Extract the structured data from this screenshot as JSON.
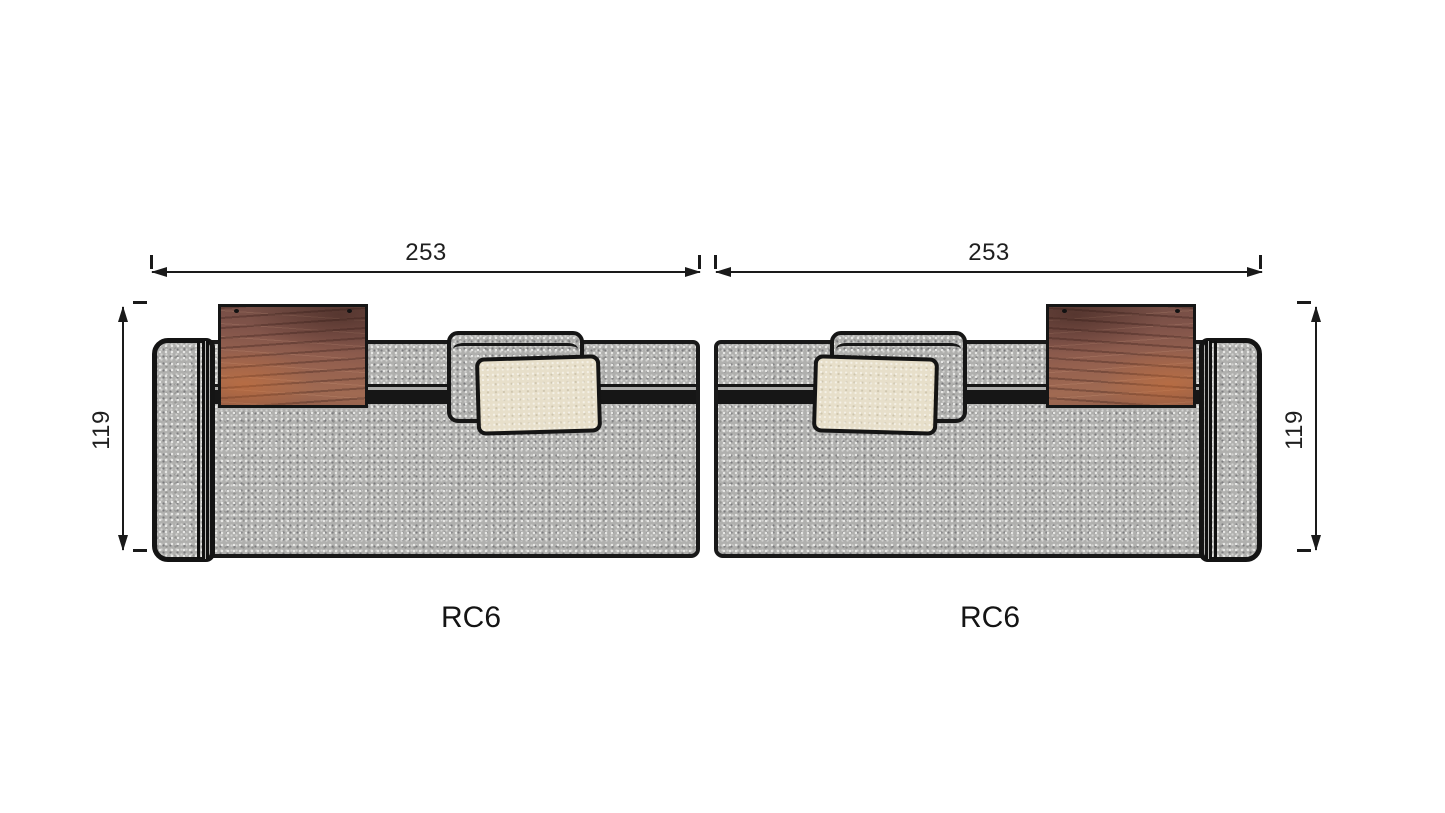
{
  "diagram": {
    "type": "furniture-top-view-dimension-drawing",
    "modules": [
      {
        "label": "RC6",
        "width": "253",
        "depth": "119",
        "arm_side": "left"
      },
      {
        "label": "RC6",
        "width": "253",
        "depth": "119",
        "arm_side": "right"
      }
    ]
  },
  "colors": {
    "background": "#ffffff",
    "outline": "#1a1a1a",
    "fabric_gray": "#b0b0ae",
    "seam_black": "#161616",
    "wood_dark": "#6e4a42",
    "wood_mid": "#95614f",
    "wood_light": "#a06a52",
    "wood_accent_orange": "#d67030",
    "pillow_cream": "#e7dfca",
    "dimension_text": "#1f1f1f"
  }
}
